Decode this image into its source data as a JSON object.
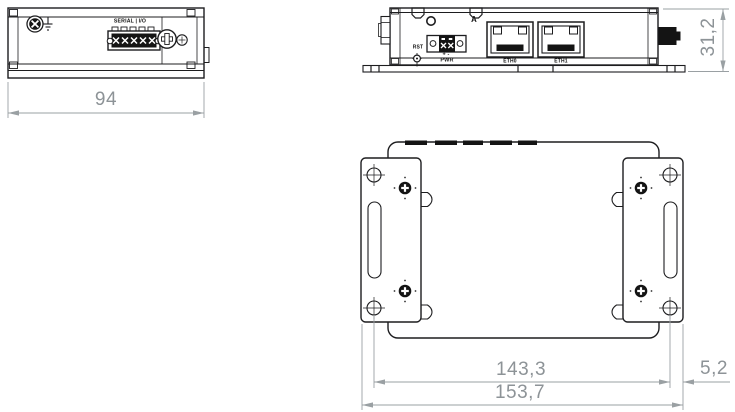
{
  "drawing": {
    "side_view": {
      "port_label": "SERIAL | I/O",
      "width_dim": "94"
    },
    "front_view": {
      "antenna_label": "A",
      "reset_label": "RST",
      "polarity_label": "+ -",
      "power_label": "PWR",
      "eth0_label": "ETH0",
      "eth1_label": "ETH1",
      "height_dim": "31,2"
    },
    "bottom_view": {
      "hole_span_dim": "143,3",
      "slot_offset_dim": "5,2",
      "overall_width_dim": "153,7"
    },
    "colors": {
      "line": "#1d1d1f",
      "dimension": "#8d9397",
      "background": "#ffffff"
    }
  }
}
